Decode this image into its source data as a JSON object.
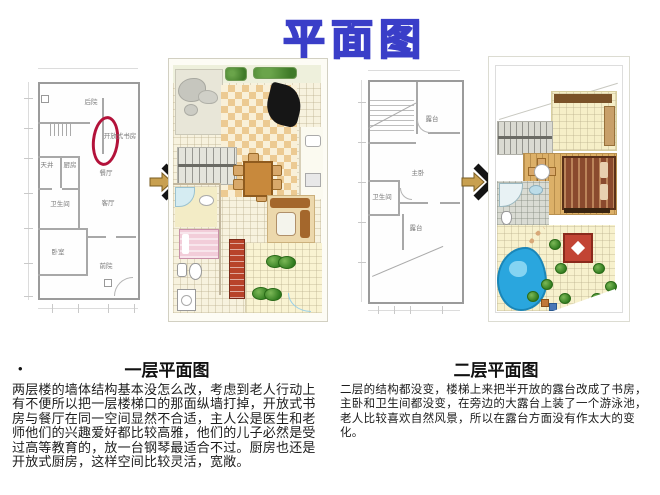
{
  "slide": {
    "title": "平面图"
  },
  "colors": {
    "title_blue": "#3a3ec8",
    "annotation_red": "#b3123a",
    "pool_blue": "#2aa6de",
    "arrow_black": "#141414",
    "arrow_tan": "#c8a050",
    "checker_tan": "#ecca92"
  },
  "arrows": {
    "direction": "right"
  },
  "plan1": {
    "rooms": {
      "backyard": "后院",
      "open_study": "开放式书房",
      "lightwell": "天井",
      "kitchen": "厨房",
      "dining": "餐厅",
      "bathroom": "卫生间",
      "living": "客厅",
      "bedroom": "卧室",
      "frontyard": "前院"
    }
  },
  "plan3": {
    "rooms": {
      "terrace_upper": "露台",
      "master_bedroom": "主卧",
      "bathroom": "卫生间",
      "terrace": "露台"
    }
  },
  "sections": {
    "first_floor": {
      "bullet": "•",
      "title": "一层平面图",
      "body": "两层楼的墙体结构基本没怎么改，考虑到老人行动上有不便所以把一层楼梯口的那面纵墙打掉，开放式书房与餐厅在同一空间显然不合适，主人公是医生和老师他们的兴趣爱好都比较高雅，他们的儿子必然是受过高等教育的，放一台钢琴最适合不过。厨房也还是开放式厨房，这样空间比较灵活，宽敞。"
    },
    "second_floor": {
      "title": "二层平面图",
      "body": "二层的结构都没变，楼梯上来把半开放的露台改成了书房，主卧和卫生间都没变，在旁边的大露台上装了一个游泳池，老人比较喜欢自然风景，所以在露台方面没有作太大的变化。"
    }
  }
}
